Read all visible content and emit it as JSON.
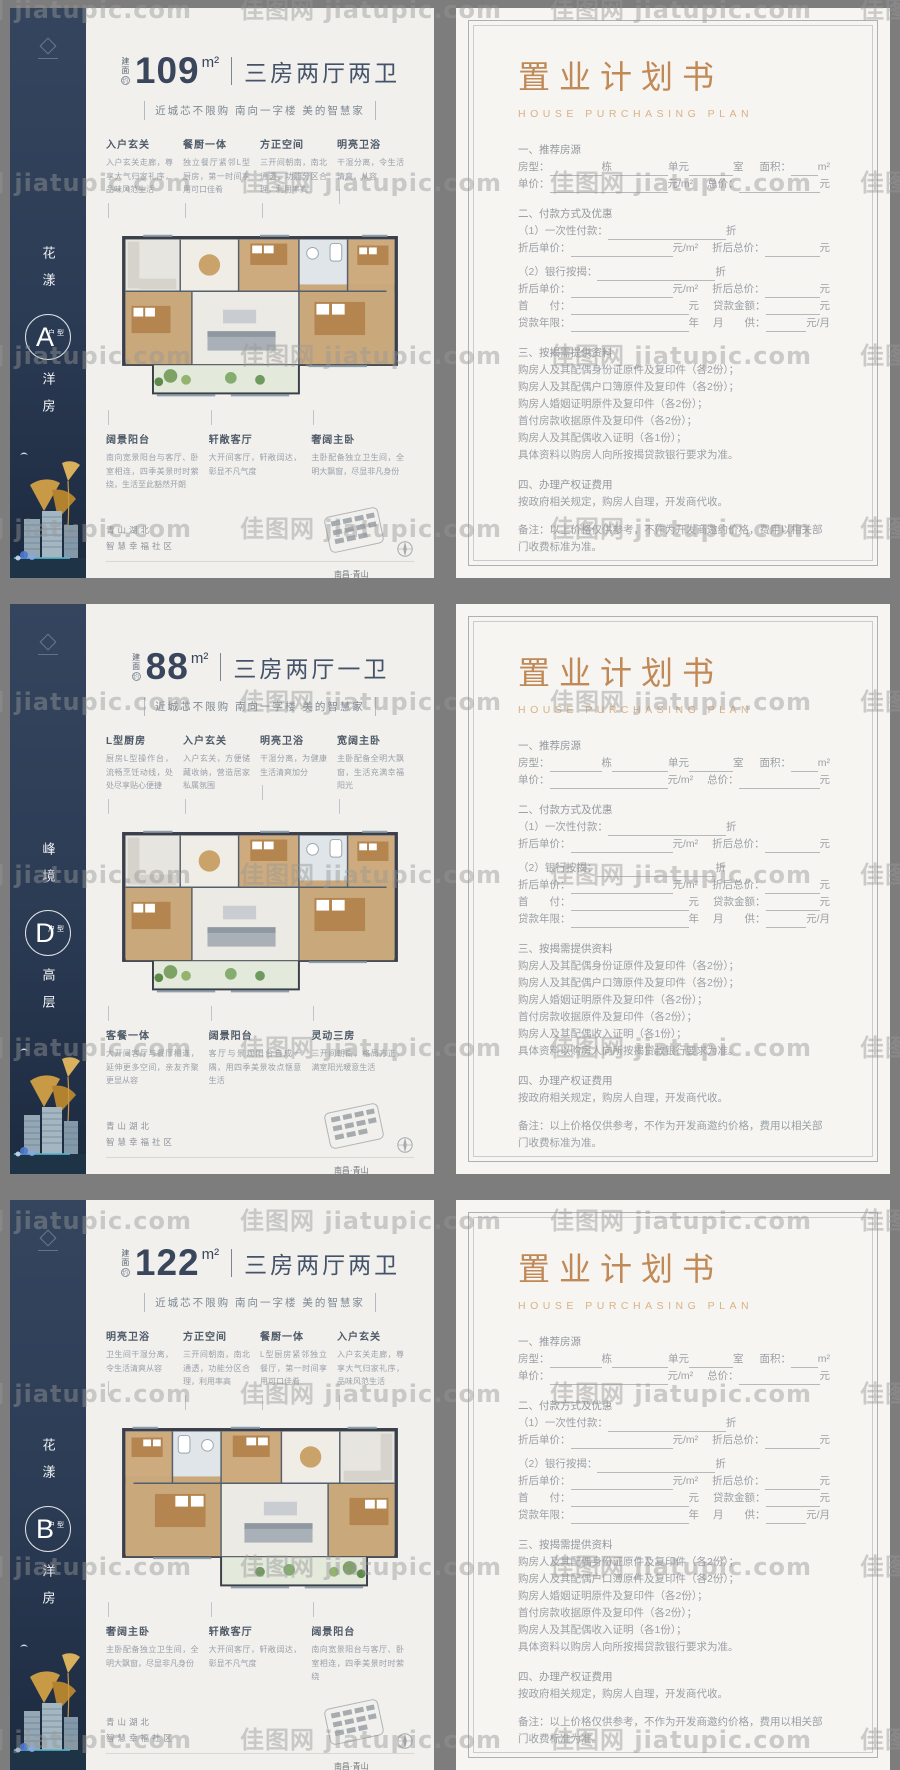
{
  "watermark": "佳图网 jiatupic.com",
  "shared": {
    "area_label": "建面",
    "approx": "约",
    "type_suffix": "户型",
    "tagline": "近城芯不限购  南向一字楼  美的智慧家",
    "loc1": "青山湖北",
    "loc2": "智慧幸福社区",
    "phone": "8508 8889",
    "addr_label": "地址",
    "addr": "南昌·青山湖北·蒋巷西大道东（江西传媒学院斜对面）"
  },
  "flyers": [
    {
      "series": "花漾",
      "letter": "A",
      "category": "洋房",
      "area": "109",
      "unit": "m²",
      "rooms": "三房两厅两卫",
      "mirrored": false,
      "annotations_top": [
        {
          "t": "入户玄关",
          "d": "入户玄关走廊，尊享大气归家礼序，品味风范生活"
        },
        {
          "t": "餐厨一体",
          "d": "独立餐厅紧邻L型厨房，第一时间享用可口佳肴"
        },
        {
          "t": "方正空间",
          "d": "三开间朝南，南北通透，功能分区合理，利用率高"
        },
        {
          "t": "明亮卫浴",
          "d": "干湿分离，令生活清爽，从容"
        }
      ],
      "annotations_bottom": [
        {
          "t": "阔景阳台",
          "d": "南向宽景阳台与客厅、卧室相连，四季美景时时萦绕，生活至此豁然开朗"
        },
        {
          "t": "轩敞客厅",
          "d": "大开间客厅，轩敞阔达，彰显不凡气度"
        },
        {
          "t": "奢阔主卧",
          "d": "主卧配备独立卫生间，全明大飘窗，尽显非凡身份"
        }
      ]
    },
    {
      "series": "峰境",
      "letter": "D",
      "category": "高层",
      "area": "88",
      "unit": "m²",
      "rooms": "三房两厅一卫",
      "mirrored": false,
      "annotations_top": [
        {
          "t": "L型厨房",
          "d": "厨房L型操作台，流畅烹饪动线，处处尽享贴心便捷"
        },
        {
          "t": "入户玄关",
          "d": "入户玄关，方便储藏收纳，营造居家私属氛围"
        },
        {
          "t": "明亮卫浴",
          "d": "干湿分离，为健康生活清爽加分"
        },
        {
          "t": "宽阔主卧",
          "d": "主卧配备全明大飘窗，生活充满幸福阳光"
        }
      ],
      "annotations_bottom": [
        {
          "t": "客餐一体",
          "d": "大开间客厅与餐厅相连，延伸更多空间，亲友齐聚更显从容"
        },
        {
          "t": "阔景阳台",
          "d": "客厅与景观阳台自成一隅，用四季美景妆点惬意生活"
        },
        {
          "t": "灵动三房",
          "d": "三开间朝南，格局方正，满室阳光暖意生活"
        }
      ]
    },
    {
      "series": "花漾",
      "letter": "B",
      "category": "洋房",
      "area": "122",
      "unit": "m²",
      "rooms": "三房两厅两卫",
      "mirrored": true,
      "annotations_top": [
        {
          "t": "明亮卫浴",
          "d": "卫生间干湿分离，令生活清爽从容"
        },
        {
          "t": "方正空间",
          "d": "三开间朝南，南北通透，功能分区合理，利用率高"
        },
        {
          "t": "餐厨一体",
          "d": "L型厨房紧邻独立餐厅，第一时间享用可口佳肴"
        },
        {
          "t": "入户玄关",
          "d": "入户玄关走廊，尊享大气归家礼序，品味风范生活"
        }
      ],
      "annotations_bottom": [
        {
          "t": "奢阔主卧",
          "d": "主卧配备独立卫生间，全明大飘窗，尽显非凡身份"
        },
        {
          "t": "轩敞客厅",
          "d": "大开间客厅，轩敞阔达，彰显不凡气度"
        },
        {
          "t": "阔景阳台",
          "d": "南向宽景阳台与客厅、卧室相连，四季美景时时萦绕"
        }
      ]
    }
  ],
  "doc": {
    "title": "置业计划书",
    "subtitle": "HOUSE PURCHASING PLAN",
    "lines": [
      {
        "h": "一、推荐房源"
      },
      {
        "segs": [
          [
            "t",
            "房型："
          ],
          [
            "u",
            52
          ],
          [
            "t",
            "栋"
          ],
          [
            "u",
            56
          ],
          [
            "t",
            "单元"
          ],
          [
            "u",
            44
          ],
          [
            "t",
            "室"
          ],
          [
            "g",
            16
          ],
          [
            "t",
            "面积："
          ],
          [
            "uf"
          ],
          [
            "t",
            "m²"
          ]
        ]
      },
      {
        "segs": [
          [
            "t",
            "单价："
          ],
          [
            "u",
            118
          ],
          [
            "t",
            "元/m²"
          ],
          [
            "g",
            14
          ],
          [
            "t",
            "总价："
          ],
          [
            "uf"
          ],
          [
            "t",
            "元"
          ]
        ]
      },
      {
        "sp": 1
      },
      {
        "h": "二、付款方式及优惠"
      },
      {
        "segs": [
          [
            "t",
            "（1）一次性付款："
          ],
          [
            "u",
            118
          ],
          [
            "t",
            "折"
          ]
        ]
      },
      {
        "segs": [
          [
            "t",
            "折后单价："
          ],
          [
            "u",
            102
          ],
          [
            "t",
            "元/m²"
          ],
          [
            "g",
            14
          ],
          [
            "t",
            "折后总价："
          ],
          [
            "uf"
          ],
          [
            "t",
            "元"
          ]
        ]
      },
      {
        "sp": 1
      },
      {
        "segs": [
          [
            "t",
            "（2）银行按揭："
          ],
          [
            "u",
            118
          ],
          [
            "t",
            "折"
          ]
        ]
      },
      {
        "segs": [
          [
            "t",
            "折后单价："
          ],
          [
            "u",
            102
          ],
          [
            "t",
            "元/m²"
          ],
          [
            "g",
            14
          ],
          [
            "t",
            "折后总价："
          ],
          [
            "uf"
          ],
          [
            "t",
            "元"
          ]
        ]
      },
      {
        "segs": [
          [
            "t",
            "首　　付："
          ],
          [
            "u",
            118
          ],
          [
            "t",
            "元"
          ],
          [
            "g",
            14
          ],
          [
            "t",
            "贷款金额："
          ],
          [
            "uf"
          ],
          [
            "t",
            "元"
          ]
        ]
      },
      {
        "segs": [
          [
            "t",
            "贷款年限："
          ],
          [
            "u",
            118
          ],
          [
            "t",
            "年"
          ],
          [
            "g",
            14
          ],
          [
            "t",
            "月　　供："
          ],
          [
            "uf"
          ],
          [
            "t",
            "元/月"
          ]
        ]
      },
      {
        "sp": 1
      },
      {
        "h": "三、按揭需提供资料"
      },
      {
        "p": "购房人及其配偶身份证原件及复印件（各2份）；"
      },
      {
        "p": "购房人及其配偶户口簿原件及复印件（各2份）；"
      },
      {
        "p": "购房人婚姻证明原件及复印件（各2份）；"
      },
      {
        "p": "首付房款收据原件及复印件（各2份）；"
      },
      {
        "p": "购房人及其配偶收入证明（各1份）；"
      },
      {
        "p": "具体资料以购房人向所按揭贷款银行要求为准。"
      },
      {
        "sp": 1
      },
      {
        "h": "四、办理产权证费用"
      },
      {
        "p": "按政府相关规定，购房人自理，开发商代收。"
      },
      {
        "sp": 2
      },
      {
        "p": "备注：以上价格仅供参考，不作为开发商邀约价格，费用以相关部门收费标准为准。"
      },
      {
        "sp": 2
      },
      {
        "segs": [
          [
            "t",
            "置业顾问："
          ],
          [
            "u",
            128
          ],
          [
            "g",
            22
          ],
          [
            "t",
            "联系方式："
          ],
          [
            "uf"
          ]
        ]
      }
    ]
  }
}
